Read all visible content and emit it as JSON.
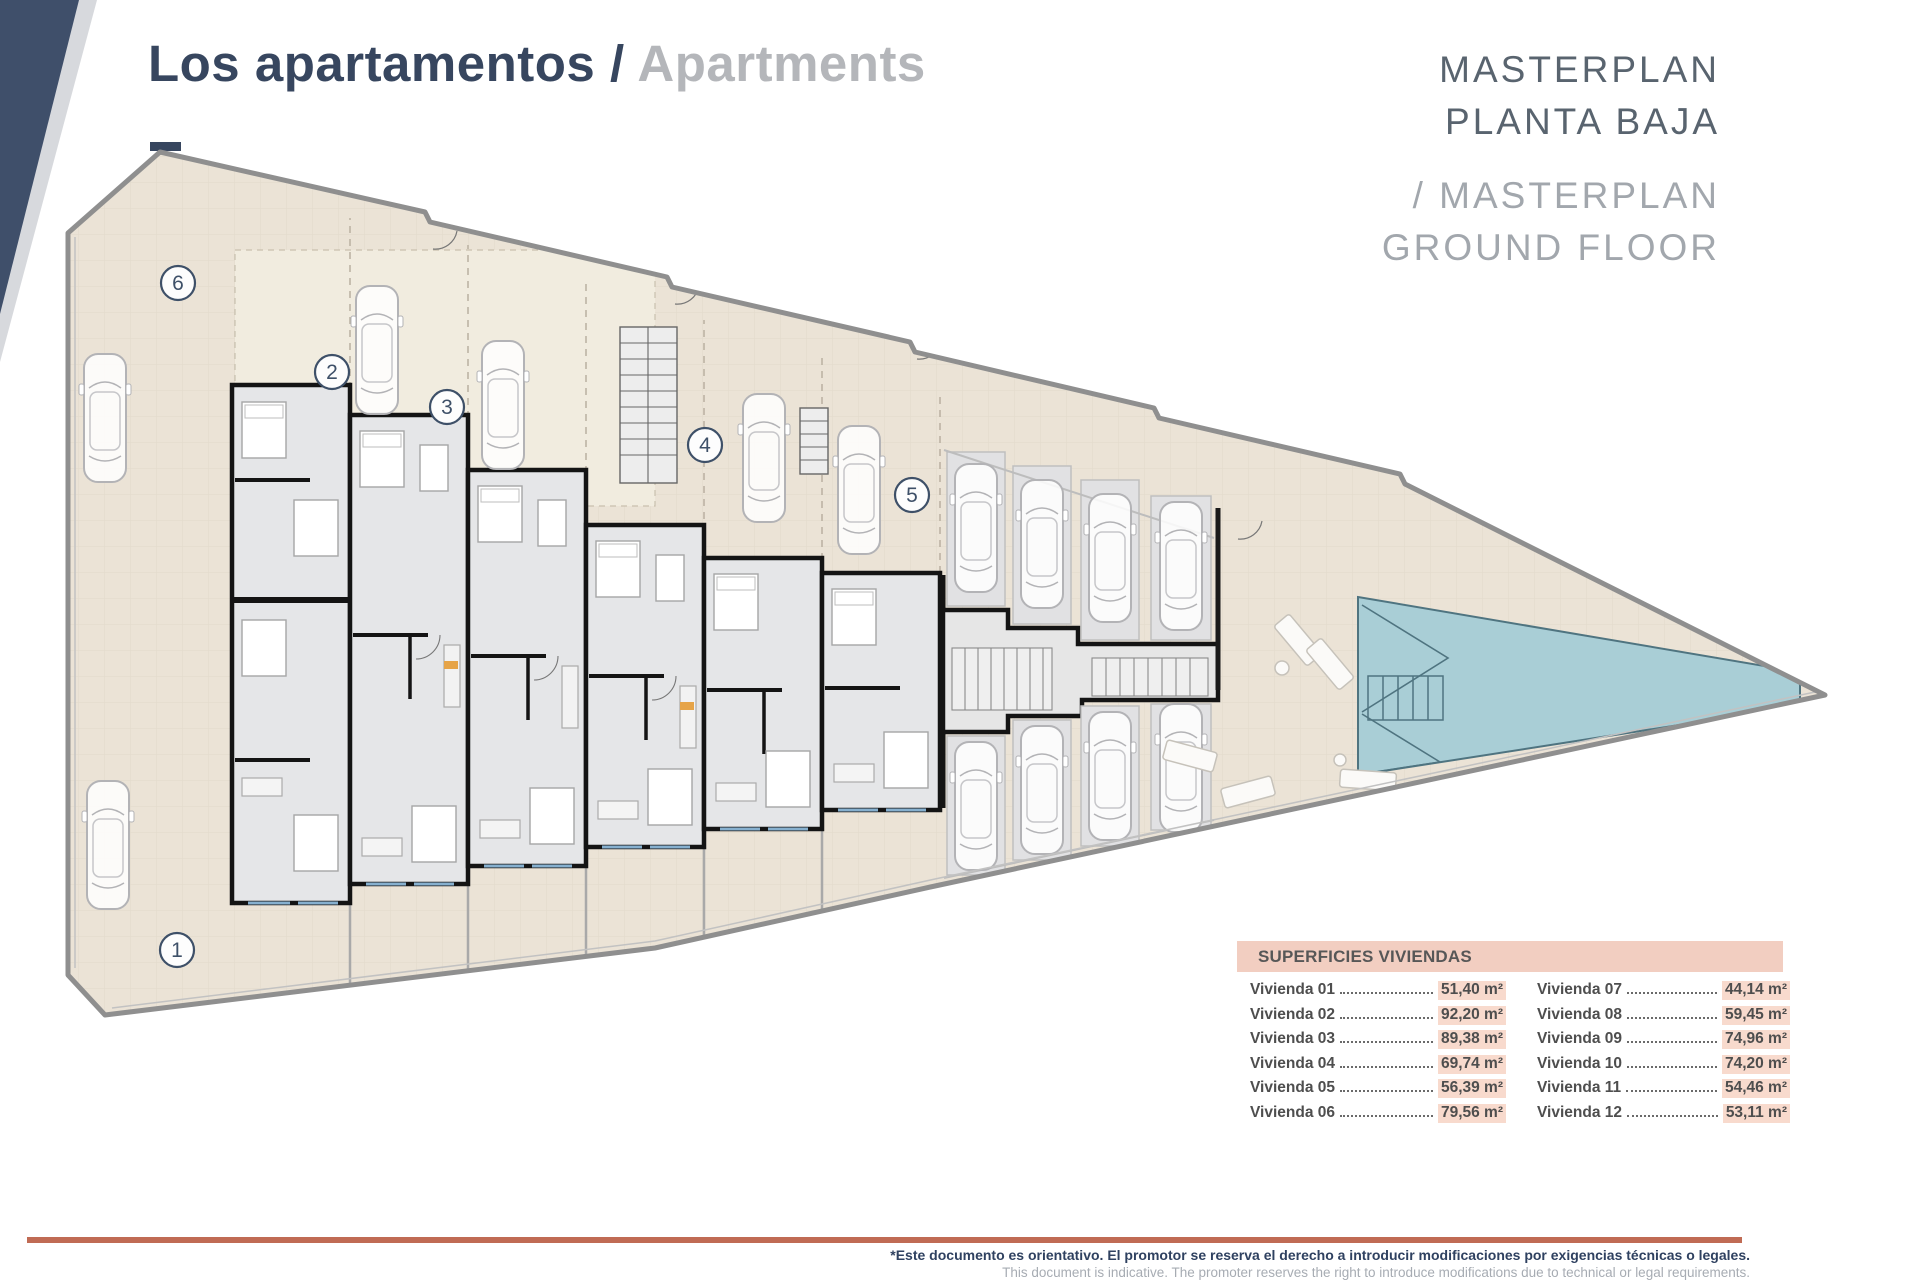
{
  "header": {
    "title_es": "Los apartamentos",
    "title_sep": " / ",
    "title_en": "Apartments"
  },
  "masterplan": {
    "es_line1": "MASTERPLAN",
    "es_line2": "PLANTA BAJA",
    "en_line1": "/ MASTERPLAN",
    "en_line2": "GROUND FLOOR"
  },
  "plan": {
    "unit_badges": {
      "u1": "1",
      "u2": "2",
      "u3": "3",
      "u4": "4",
      "u5": "5",
      "u6": "6"
    }
  },
  "areas_table": {
    "title": "SUPERFICIES VIVIENDAS",
    "col1": [
      {
        "label": "Vivienda 01",
        "value": "51,40 m²"
      },
      {
        "label": "Vivienda 02",
        "value": "92,20 m²"
      },
      {
        "label": "Vivienda 03",
        "value": "89,38 m²"
      },
      {
        "label": "Vivienda 04",
        "value": "69,74 m²"
      },
      {
        "label": "Vivienda 05",
        "value": "56,39 m²"
      },
      {
        "label": "Vivienda 06",
        "value": "79,56 m²"
      }
    ],
    "col2": [
      {
        "label": "Vivienda 07",
        "value": "44,14 m²"
      },
      {
        "label": "Vivienda 08",
        "value": "59,45 m²"
      },
      {
        "label": "Vivienda 09",
        "value": "74,96 m²"
      },
      {
        "label": "Vivienda 10",
        "value": "74,20 m²"
      },
      {
        "label": "Vivienda 11",
        "value": "54,46 m²"
      },
      {
        "label": "Vivienda 12",
        "value": "53,11 m²"
      }
    ]
  },
  "footer": {
    "note_es": "*Este documento es orientativo. El promotor se reserva el derecho a introducir modificaciones por exigencias técnicas o legales.",
    "note_en": "This document is indicative. The promoter reserves the right to introduce modifications due to technical or legal requirements."
  },
  "colors": {
    "navy": "#37465f",
    "terracotta": "#c06b54",
    "table_header_bg": "#f2cec1",
    "value_highlight": "#f8dacd",
    "pool": "#a9ced6",
    "plan_beige": "#ebe3d6"
  }
}
